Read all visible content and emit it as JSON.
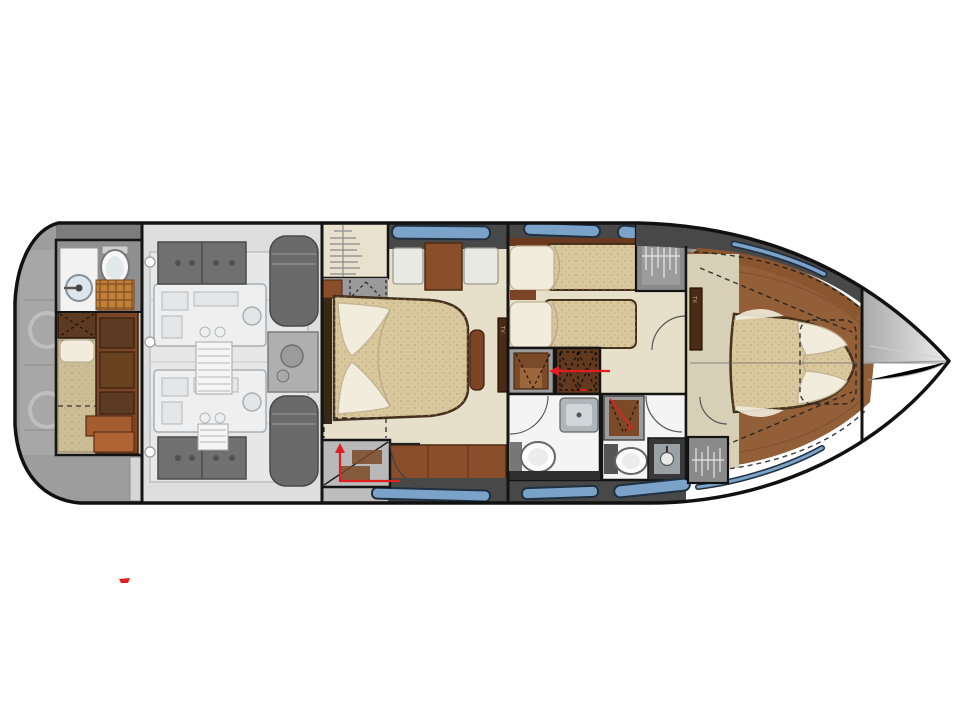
{
  "figure": {
    "type": "yacht-deck-plan",
    "title": "Motor yacht lower deck accommodation plan",
    "orientation": "bow-right",
    "deck": "lower deck"
  },
  "labels": {
    "tv": "TV"
  },
  "rooms": {
    "swim_platform": "aft platform",
    "crew_cabin": "crew cabin with single berth and wet head",
    "engine_room": "engine room with twin engines (ghosted)",
    "aft_stairs": "aft companionway steps",
    "vip_cabin": "midship cabin with island double bed",
    "twin_cabin": "twin-berth guest cabin",
    "mid_bathroom": "guest bathroom with separate shower",
    "fwd_bathroom": "forward day head with shower",
    "owner_cabin": "forward owner's stateroom with island bed",
    "bow_deck": "foredeck"
  },
  "annotations": {
    "red_arrow_aft": "entry path up companionway",
    "red_arrow_corridor": "entry path into corridor",
    "red_mark_shower": "shower note",
    "red_mark_stray": "stray red mark lower left"
  },
  "colors": {
    "hull_outline": "#111111",
    "band_charcoal": "#484848",
    "window_blue": "#7ba3c9",
    "window_frame": "#203040",
    "platform_gray": "#9d9d9d",
    "crew_gray": "#8f8f8f",
    "engine_floor": "#d9d9d9",
    "machinery_light": "#ededed",
    "machinery_stroke": "#9aa0a4",
    "machinery_dark": "#575757",
    "floor_beige": "#e6dfca",
    "carpet_beige": "#d8d0b6",
    "wood_brown": "#935f38",
    "wood_dark": "#6f4629",
    "trim_brown": "#8a5630",
    "mattress_tan": "#d9c79e",
    "mattress_edge": "#44301c",
    "pillow_white": "#f2ecdc",
    "pillow_edge": "#c2b493",
    "furniture_brown": "#8a4f2a",
    "furniture_dark": "#4a2c16",
    "shower_brown": "#7b4a28",
    "wicker_orange": "#c08038",
    "bath_white": "#f4f4f4",
    "fixture_gray": "#aeb6ba",
    "counter_dark": "#2e2e2e",
    "wardrobe_gray": "#8a8a8a",
    "hanger_white": "#e8e8e8",
    "accent_red": "#e02020",
    "bow_gray": "#b0b0b0"
  }
}
